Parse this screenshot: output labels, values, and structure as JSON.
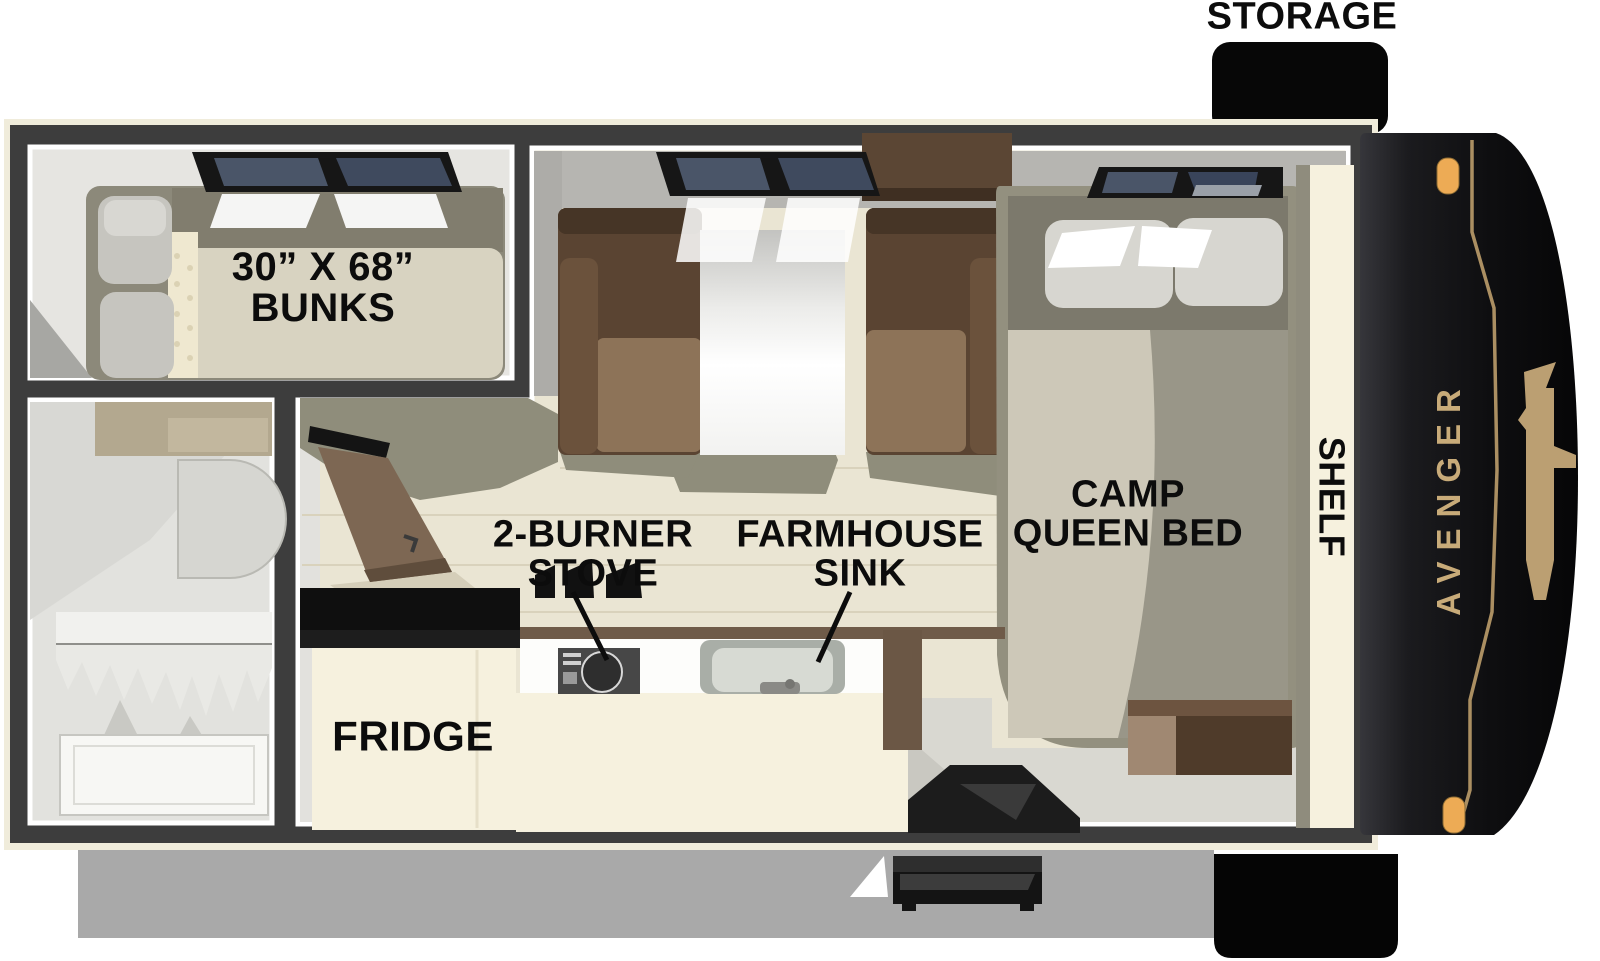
{
  "floorplan": {
    "brand": "AVENGER",
    "labels": {
      "storage": "STORAGE",
      "bunks": [
        "30” X 68”",
        "BUNKS"
      ],
      "stove": [
        "2-BURNER",
        "STOVE"
      ],
      "sink": [
        "FARMHOUSE",
        "SINK"
      ],
      "camp_bed": [
        "CAMP",
        "QUEEN BED"
      ],
      "shelf": "SHELF",
      "fridge": "FRIDGE"
    },
    "colors": {
      "accent_gold": "#bfa172",
      "wall_dark": "#3d3d3d",
      "floor_cream": "#eae5d3",
      "floor_olive": "#8f8d7b",
      "cabinet_cream": "#f6f1de",
      "seat_brown": "#5a4432",
      "counter_black": "#141414",
      "window_glass": "#4a5568",
      "marker_light": "#edab55",
      "shadow_gray": "#a9a9a9"
    }
  }
}
